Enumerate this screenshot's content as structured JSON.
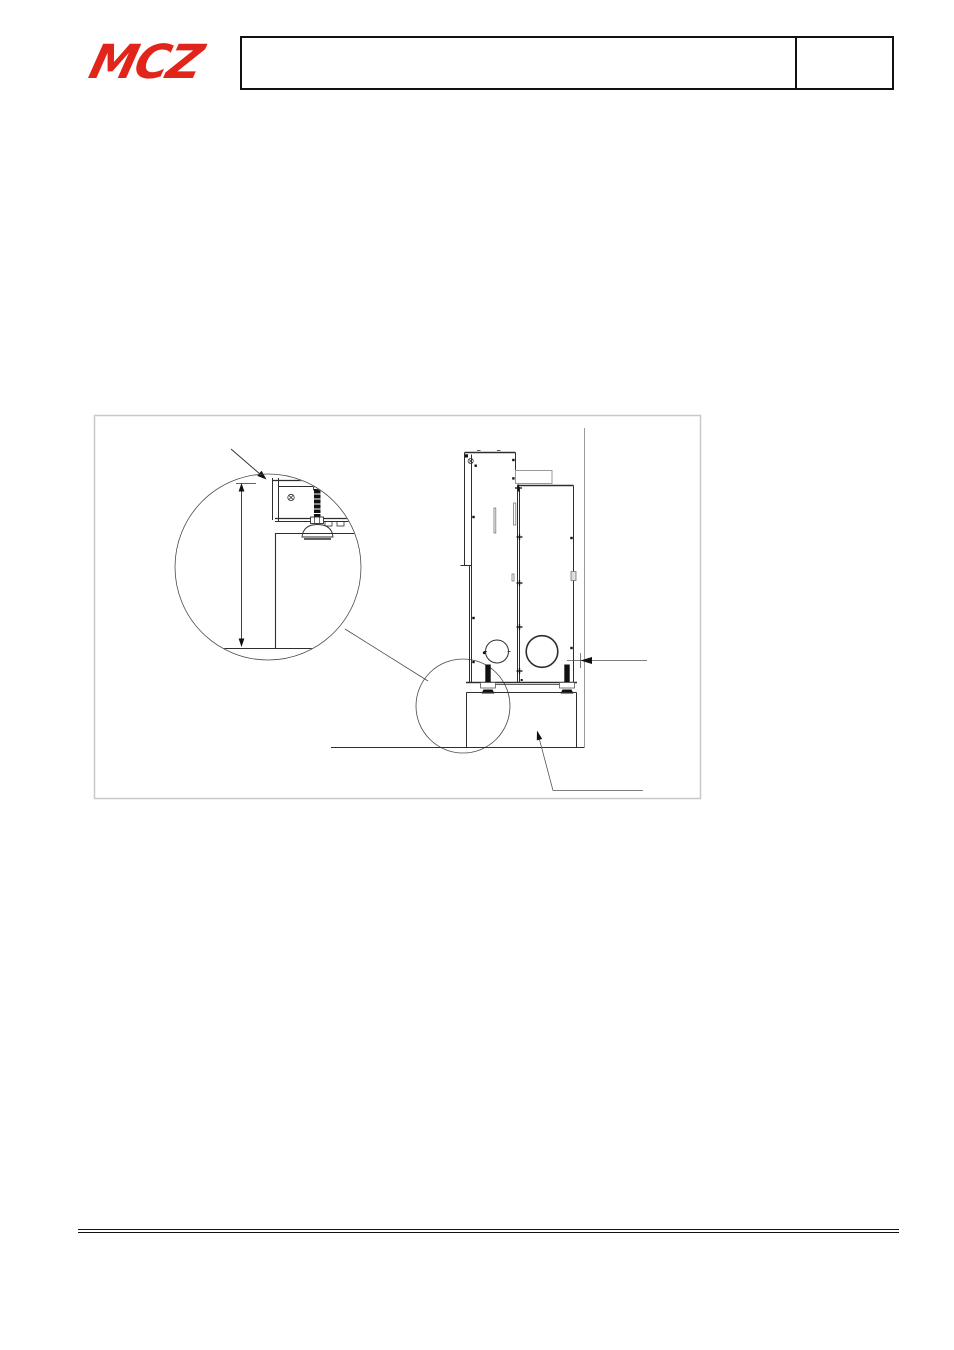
{
  "page": {
    "width": 954,
    "height": 1350,
    "background": "#ffffff"
  },
  "header": {
    "logo_text": "MCZ",
    "logo_color": "#e1251b",
    "title_box_text": "",
    "code_box_text": ""
  },
  "figure": {
    "type": "technical-drawing",
    "description": "Side view of a pellet stove standing on a pedestal base against a wall, with a large magnified detail circle of the adjustable levelling foot and lower corner, a small locator circle at the stove base, a clearance arrow to the wall and a leader arrow pointing to the pedestal",
    "frame_color": "#c8c8c8",
    "line_color": "#2e2e2e",
    "accent_black": "#111111",
    "text_labels": []
  },
  "footer": {
    "rule_style": "double-line"
  }
}
